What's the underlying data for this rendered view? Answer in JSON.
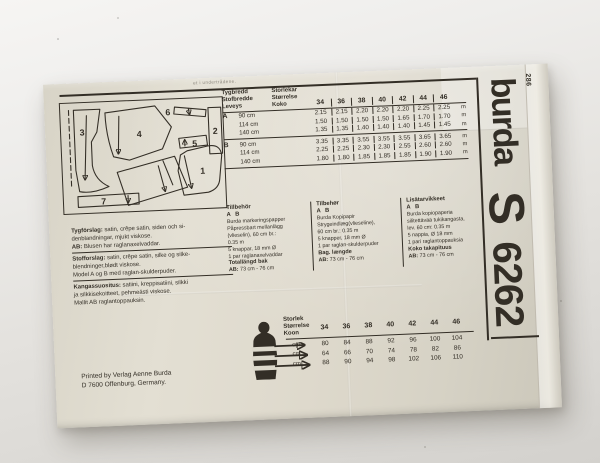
{
  "envelope": {
    "top_edge_fragment": "et i undertrådene.",
    "brand_logo": "burda",
    "edition_code": "286",
    "size_letter": "S",
    "pattern_number": "6262",
    "printer_line1": "Printed by Verlag Aenne Burda",
    "printer_line2": "D 7600 Offenburg, Germany."
  },
  "cutting_layout": {
    "pieces": [
      "1",
      "2",
      "3",
      "4",
      "5",
      "6",
      "7"
    ]
  },
  "fabric_table": {
    "width_header": [
      "Tygbredd",
      "Stofbredde",
      "Leveys"
    ],
    "size_header": [
      "Storlekar",
      "Størrelse",
      "Koko"
    ],
    "sizes": [
      "34",
      "36",
      "38",
      "40",
      "42",
      "44",
      "46"
    ],
    "unit": "m",
    "groups": [
      {
        "view": "A",
        "rows": [
          {
            "width": "90 cm",
            "values": [
              "2.15",
              "2.15",
              "2.20",
              "2.20",
              "2.20",
              "2.25",
              "2.25"
            ]
          },
          {
            "width": "114 cm",
            "values": [
              "1.50",
              "1.50",
              "1.50",
              "1.50",
              "1.65",
              "1.70",
              "1.70"
            ]
          },
          {
            "width": "140 cm",
            "values": [
              "1.35",
              "1.35",
              "1.40",
              "1.40",
              "1.40",
              "1.45",
              "1.45"
            ]
          }
        ]
      },
      {
        "view": "B",
        "rows": [
          {
            "width": "90 cm",
            "values": [
              "3.35",
              "3.35",
              "3.55",
              "3.55",
              "3.55",
              "3.65",
              "3.65"
            ]
          },
          {
            "width": "114 cm",
            "values": [
              "2.25",
              "2.25",
              "2.30",
              "2.30",
              "2.55",
              "2.60",
              "2.60"
            ]
          },
          {
            "width": "140 cm",
            "values": [
              "1.80",
              "1.80",
              "1.85",
              "1.85",
              "1.85",
              "1.90",
              "1.90"
            ]
          }
        ]
      }
    ]
  },
  "fabric_advice": {
    "groups": [
      {
        "rule": true,
        "lines": [
          {
            "b": "Tygförslag:",
            "t": " satin, crêpe satin, siden och si-"
          },
          {
            "b": "",
            "t": "denblandningar, mjukt viskose."
          },
          {
            "b": "AB:",
            "t": " Blusen har raglanaxelvaddar."
          }
        ]
      },
      {
        "rule": true,
        "lines": [
          {
            "b": "Stofforslag:",
            "t": " satin, crêpe satin, silke og silke-"
          },
          {
            "b": "",
            "t": "blendninger,blødt viskose."
          },
          {
            "b": "",
            "t": "Model A og B med raglan-skulderpuder."
          }
        ]
      },
      {
        "rule": false,
        "lines": [
          {
            "b": "Kangassuositus:",
            "t": " satiini, kreppisatiini, silkki"
          },
          {
            "b": "",
            "t": "ja silkkisekoitteet, pehmeästi viskose."
          },
          {
            "b": "",
            "t": "Mallit AB raglantoppauksin."
          }
        ]
      }
    ]
  },
  "notions": {
    "columns": [
      {
        "title": "Tillbehör",
        "ab": "A B",
        "lines": [
          "Burda markeringspapper",
          "Påpressbart mellanlägg",
          "(vlieselin), 60 cm br.:",
          "0.35 m",
          "5 knappar, 18 mm Ø",
          "1 par raglanaxelvaddar"
        ],
        "footer_title": "Totallängd bak",
        "footer_ab": "AB:",
        "footer_value": "73 cm - 76 cm"
      },
      {
        "title": "Tilbehør",
        "ab": "A B",
        "lines": [
          "Burda Kopipapir",
          "Strygeindlæg(vlieseline),",
          "60 cm br.: 0.35 m",
          "5 knapper, 18 mm Ø",
          "1 par raglan-skulderpuder"
        ],
        "footer_title": "Bag. længde",
        "footer_ab": "AB:",
        "footer_value": "73 cm - 76 cm"
      },
      {
        "title": "Lisätarvikkeet",
        "ab": "A B",
        "lines": [
          "Burda kopiopaperia",
          "silitettävää tukikangasta,",
          "lev. 60 cm: 0.35 m",
          "5 nappia, Ø 18 mm",
          "1 pari raglantoppauksia"
        ],
        "footer_title": "Koko takapituus",
        "footer_ab": "AB:",
        "footer_value": "73 cm - 76 cm"
      }
    ]
  },
  "body_table": {
    "header": [
      "Storlek",
      "Størrelse",
      "Koon"
    ],
    "sizes": [
      "34",
      "36",
      "38",
      "40",
      "42",
      "44",
      "46"
    ],
    "unit": "cm",
    "rows": [
      [
        "80",
        "84",
        "88",
        "92",
        "96",
        "100",
        "104"
      ],
      [
        "64",
        "66",
        "70",
        "74",
        "78",
        "82",
        "86"
      ],
      [
        "88",
        "90",
        "94",
        "98",
        "102",
        "106",
        "110"
      ]
    ]
  },
  "colors": {
    "ink": "#332e26",
    "paper": "#dcd8cb"
  }
}
